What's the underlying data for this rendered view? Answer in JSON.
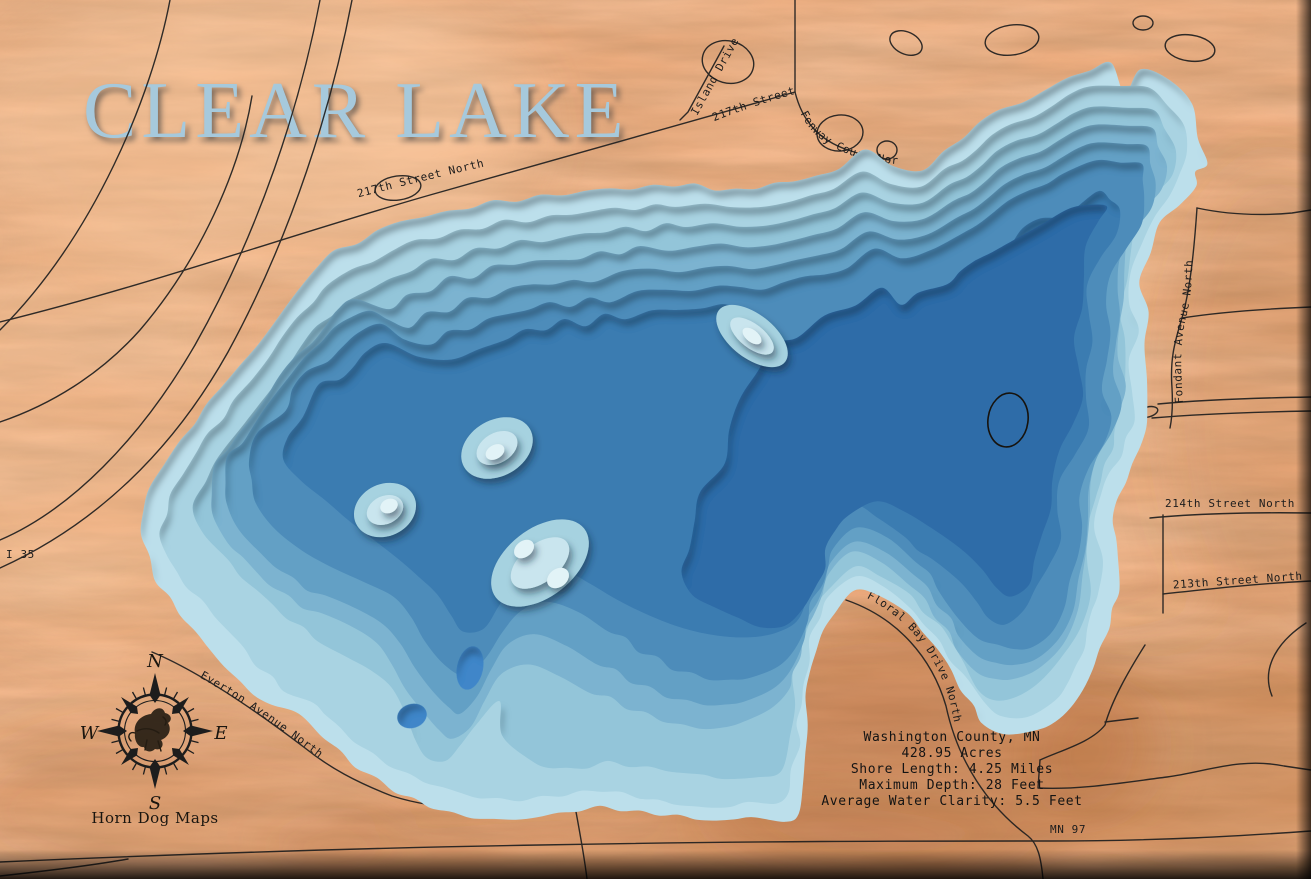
{
  "map": {
    "title": "CLEAR LAKE",
    "title_color": "#a6c9dc",
    "maker": "Horn Dog Maps",
    "compass": {
      "n": "N",
      "e": "E",
      "s": "S",
      "w": "W"
    },
    "marker_ring_color": "#17130d"
  },
  "stats": {
    "lines": [
      "Washington County, MN",
      "428.95 Acres",
      "Shore Length: 4.25 Miles",
      "Maximum Depth: 28 Feet",
      "Average Water Clarity: 5.5 Feet"
    ]
  },
  "roads": {
    "i35": "I 35",
    "street_217": "217th Street North",
    "street_217_b": "217th Street North",
    "fenway": "Fenway Court North",
    "island": "Island Drive",
    "fondant": "Fondant Avenue North",
    "street_214": "214th Street North",
    "street_213": "213th Street North",
    "everton": "Everton Avenue North",
    "floral_bay": "Floral Bay Drive North",
    "mn97": "MN 97"
  },
  "lake": {
    "palette": [
      "#bcdfeb",
      "#a9d3e2",
      "#93c5d9",
      "#7cb3d0",
      "#64a0c5",
      "#4d8cba",
      "#3b7bb1",
      "#2f6ca8"
    ],
    "shoal_outer": "#a6d2e0",
    "shoal_mid": "#c9e5ee",
    "shoal_core": "#e2f3f7",
    "pocket": "#3f86c9"
  },
  "wood": {
    "base": "#efae80",
    "ink": "#1f1f1f"
  }
}
